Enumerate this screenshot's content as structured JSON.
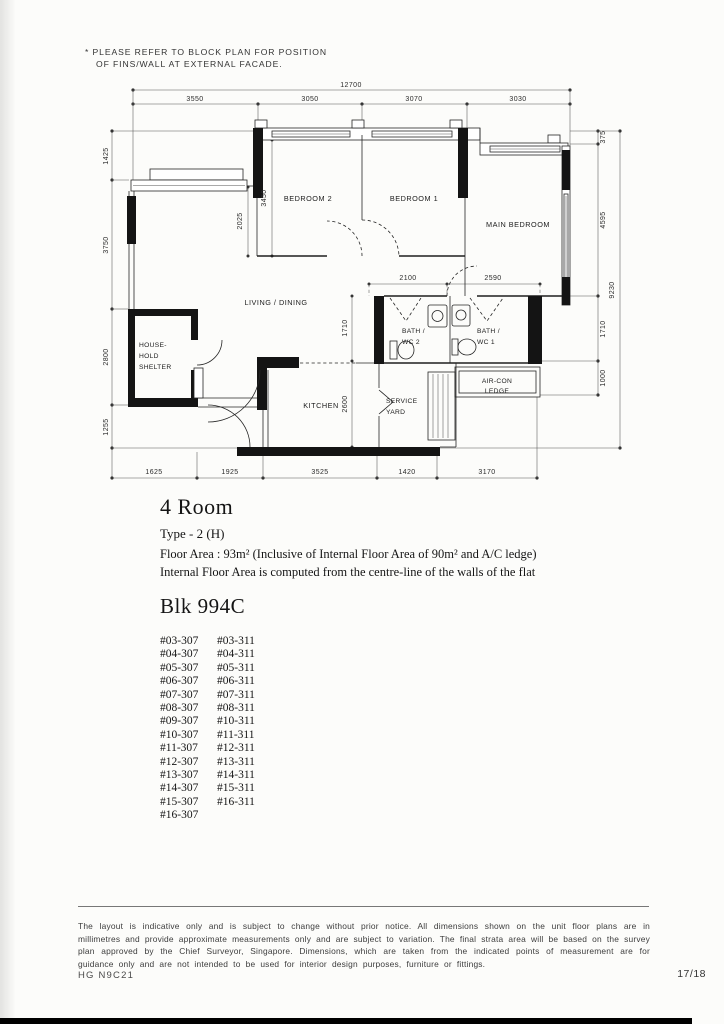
{
  "note": {
    "line1": "* PLEASE REFER TO BLOCK PLAN FOR POSITION",
    "line2": "OF FINS/WALL AT EXTERNAL FACADE."
  },
  "plan": {
    "dims": {
      "top_total": "12700",
      "top_segments": [
        "3550",
        "3050",
        "3070",
        "3030"
      ],
      "left": [
        "1425",
        "3750",
        "2800",
        "1255"
      ],
      "right_segments": [
        "375",
        "4595",
        "1710",
        "1000"
      ],
      "right_total": "9230",
      "bottom": [
        "1625",
        "1925",
        "3525",
        "1420",
        "3170"
      ],
      "inner": {
        "bed2": "3450",
        "bed2_lower": "2025",
        "bath2": "2100",
        "bath1": "2590",
        "hall": "1710",
        "kitchen": "2600"
      }
    },
    "rooms": {
      "bedroom2": "BEDROOM 2",
      "bedroom1": "BEDROOM 1",
      "main_bedroom": "MAIN BEDROOM",
      "living_dining": "LIVING / DINING",
      "household_l1": "HOUSE-",
      "household_l2": "HOLD",
      "household_l3": "SHELTER",
      "kitchen": "KITCHEN",
      "bath2_l1": "BATH /",
      "bath2_l2": "WC 2",
      "bath1_l1": "BATH /",
      "bath1_l2": "WC 1",
      "aircon_l1": "AIR-CON",
      "aircon_l2": "LEDGE",
      "service_l1": "SERVICE",
      "service_l2": "YARD"
    }
  },
  "unit_info": {
    "title": "4 Room",
    "type": "Type - 2 (H)",
    "area": "Floor Area : 93m²  (Inclusive of Internal Floor Area of 90m² and A/C ledge)",
    "note": "Internal Floor Area is computed from the centre-line of the walls of the flat"
  },
  "block": {
    "title": "Blk 994C",
    "units": [
      {
        "c1": "#03-307",
        "c2": "#03-311"
      },
      {
        "c1": "#04-307",
        "c2": "#04-311"
      },
      {
        "c1": "#05-307",
        "c2": "#05-311"
      },
      {
        "c1": "#06-307",
        "c2": "#06-311"
      },
      {
        "c1": "#07-307",
        "c2": "#07-311"
      },
      {
        "c1": "#08-307",
        "c2": "#08-311"
      },
      {
        "c1": "#09-307",
        "c2": "#10-311"
      },
      {
        "c1": "#10-307",
        "c2": "#11-311"
      },
      {
        "c1": "#11-307",
        "c2": "#12-311"
      },
      {
        "c1": "#12-307",
        "c2": "#13-311"
      },
      {
        "c1": "#13-307",
        "c2": "#14-311"
      },
      {
        "c1": "#14-307",
        "c2": "#15-311"
      },
      {
        "c1": "#15-307",
        "c2": "#16-311"
      },
      {
        "c1": "#16-307",
        "c2": ""
      }
    ]
  },
  "disclaimer": "The layout is indicative only and is subject to change without prior notice. All dimensions shown on the unit floor plans are in millimetres and provide approximate measurements only and are subject to variation. The final strata area will be based on the survey plan approved by the Chief Surveyor, Singapore. Dimensions, which are taken from the indicated points of measurement are for guidance only and are not intended to be used for interior design purposes, furniture or fittings.",
  "footer": {
    "left": "HG N9C21",
    "right": "17/18"
  }
}
